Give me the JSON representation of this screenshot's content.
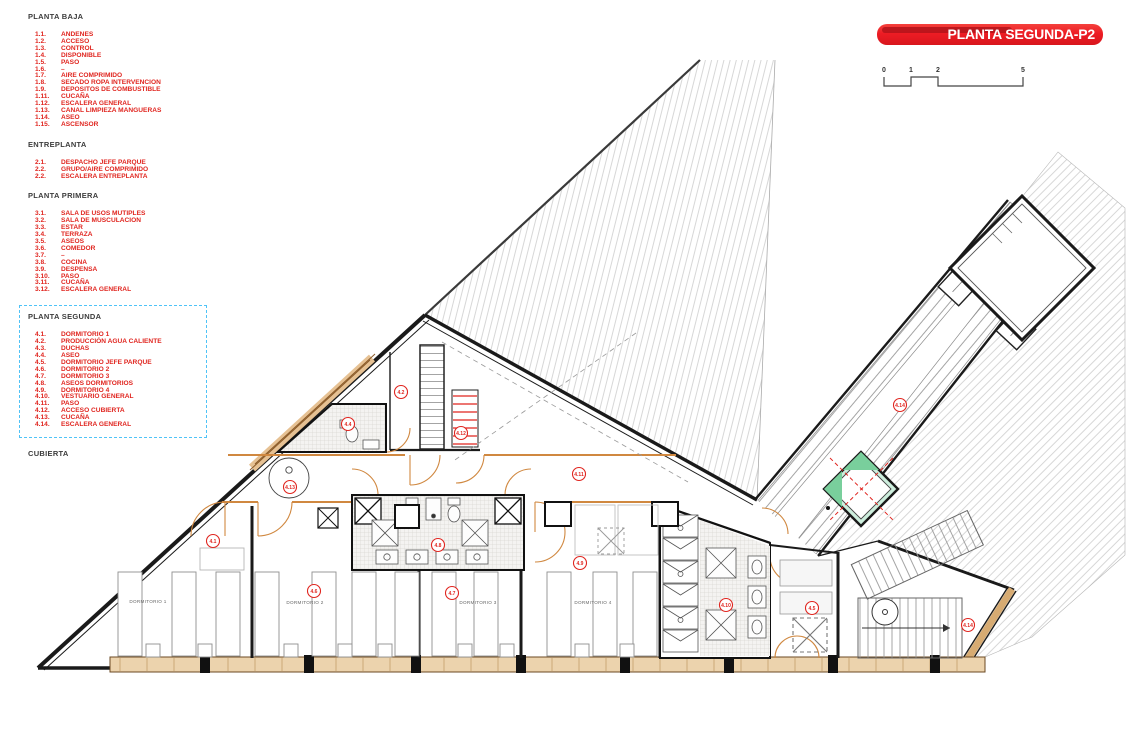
{
  "title_banner": {
    "text": "PLANTA SEGUNDA-P2"
  },
  "scale_bar": {
    "labels": [
      "0",
      "1",
      "2",
      "5"
    ]
  },
  "colors": {
    "accent_red": "#e0251f",
    "banner_red": "#ed1c24",
    "selection_blue": "#4fc3f7",
    "wood_orange": "#d08840",
    "wood_fill": "#e6c193",
    "skylight_green": "#79cf9c"
  },
  "legend": {
    "sections": [
      {
        "title": "PLANTA BAJA",
        "boxed": false,
        "items": [
          [
            "1.1.",
            "ANDENES"
          ],
          [
            "1.2.",
            "ACCESO"
          ],
          [
            "1.3.",
            "CONTROL"
          ],
          [
            "1.4.",
            "DISPONIBLE"
          ],
          [
            "1.5.",
            "PASO"
          ],
          [
            "1.6.",
            "–"
          ],
          [
            "1.7.",
            "AIRE COMPRIMIDO"
          ],
          [
            "1.8.",
            "SECADO ROPA INTERVENCION"
          ],
          [
            "1.9.",
            "DEPOSITOS DE COMBUSTIBLE"
          ],
          [
            "1.11.",
            "CUCAÑA"
          ],
          [
            "1.12.",
            "ESCALERA GENERAL"
          ],
          [
            "1.13.",
            "CANAL LIMPIEZA MANGUERAS"
          ],
          [
            "1.14.",
            "ASEO"
          ],
          [
            "1.15.",
            "ASCENSOR"
          ]
        ]
      },
      {
        "title": "ENTREPLANTA",
        "boxed": false,
        "items": [
          [
            "2.1.",
            "DESPACHO JEFE PARQUE"
          ],
          [
            "2.2.",
            "GRUPO/AIRE COMPRIMIDO"
          ],
          [
            "2.2.",
            "ESCALERA ENTREPLANTA"
          ]
        ]
      },
      {
        "title": "PLANTA PRIMERA",
        "boxed": false,
        "items": [
          [
            "3.1.",
            "SALA DE USOS MUTIPLES"
          ],
          [
            "3.2.",
            "SALA DE MUSCULACION"
          ],
          [
            "3.3.",
            "ESTAR"
          ],
          [
            "3.4.",
            "TERRAZA"
          ],
          [
            "3.5.",
            "ASEOS"
          ],
          [
            "3.6.",
            "COMEDOR"
          ],
          [
            "3.7.",
            "–"
          ],
          [
            "3.8.",
            "COCINA"
          ],
          [
            "3.9.",
            "DESPENSA"
          ],
          [
            "3.10.",
            "PASO"
          ],
          [
            "3.11.",
            "CUCAÑA"
          ],
          [
            "3.12.",
            "ESCALERA GENERAL"
          ]
        ]
      },
      {
        "title": "PLANTA SEGUNDA",
        "boxed": true,
        "items": [
          [
            "4.1.",
            "DORMITORIO 1"
          ],
          [
            "4.2.",
            "PRODUCCIÓN AGUA CALIENTE"
          ],
          [
            "4.3.",
            "DUCHAS"
          ],
          [
            "4.4.",
            "ASEO"
          ],
          [
            "4.5.",
            "DORMITORIO JEFE PARQUE"
          ],
          [
            "4.6.",
            "DORMITORIO 2"
          ],
          [
            "4.7.",
            "DORMITORIO 3"
          ],
          [
            "4.8.",
            "ASEOS DORMITORIOS"
          ],
          [
            "4.9.",
            "DORMITORIO 4"
          ],
          [
            "4.10.",
            "VESTUARIO GENERAL"
          ],
          [
            "4.11.",
            "PASO"
          ],
          [
            "4.12.",
            "ACCESO CUBIERTA"
          ],
          [
            "4.13.",
            "CUCAÑA"
          ],
          [
            "4.14.",
            "ESCALERA GENERAL"
          ]
        ]
      },
      {
        "title": "CUBIERTA",
        "boxed": false,
        "items": []
      }
    ]
  },
  "plan": {
    "room_labels": [
      "DORMITORIO 1",
      "DORMITORIO 2",
      "DORMITORIO 3",
      "DORMITORIO 4"
    ],
    "bubbles": [
      "4.1",
      "4.13",
      "4.4",
      "4.2",
      "4.12",
      "4.8",
      "4.6",
      "4.7",
      "4.9",
      "4.11",
      "4.10",
      "4.5",
      "4.14",
      "4.14"
    ]
  }
}
